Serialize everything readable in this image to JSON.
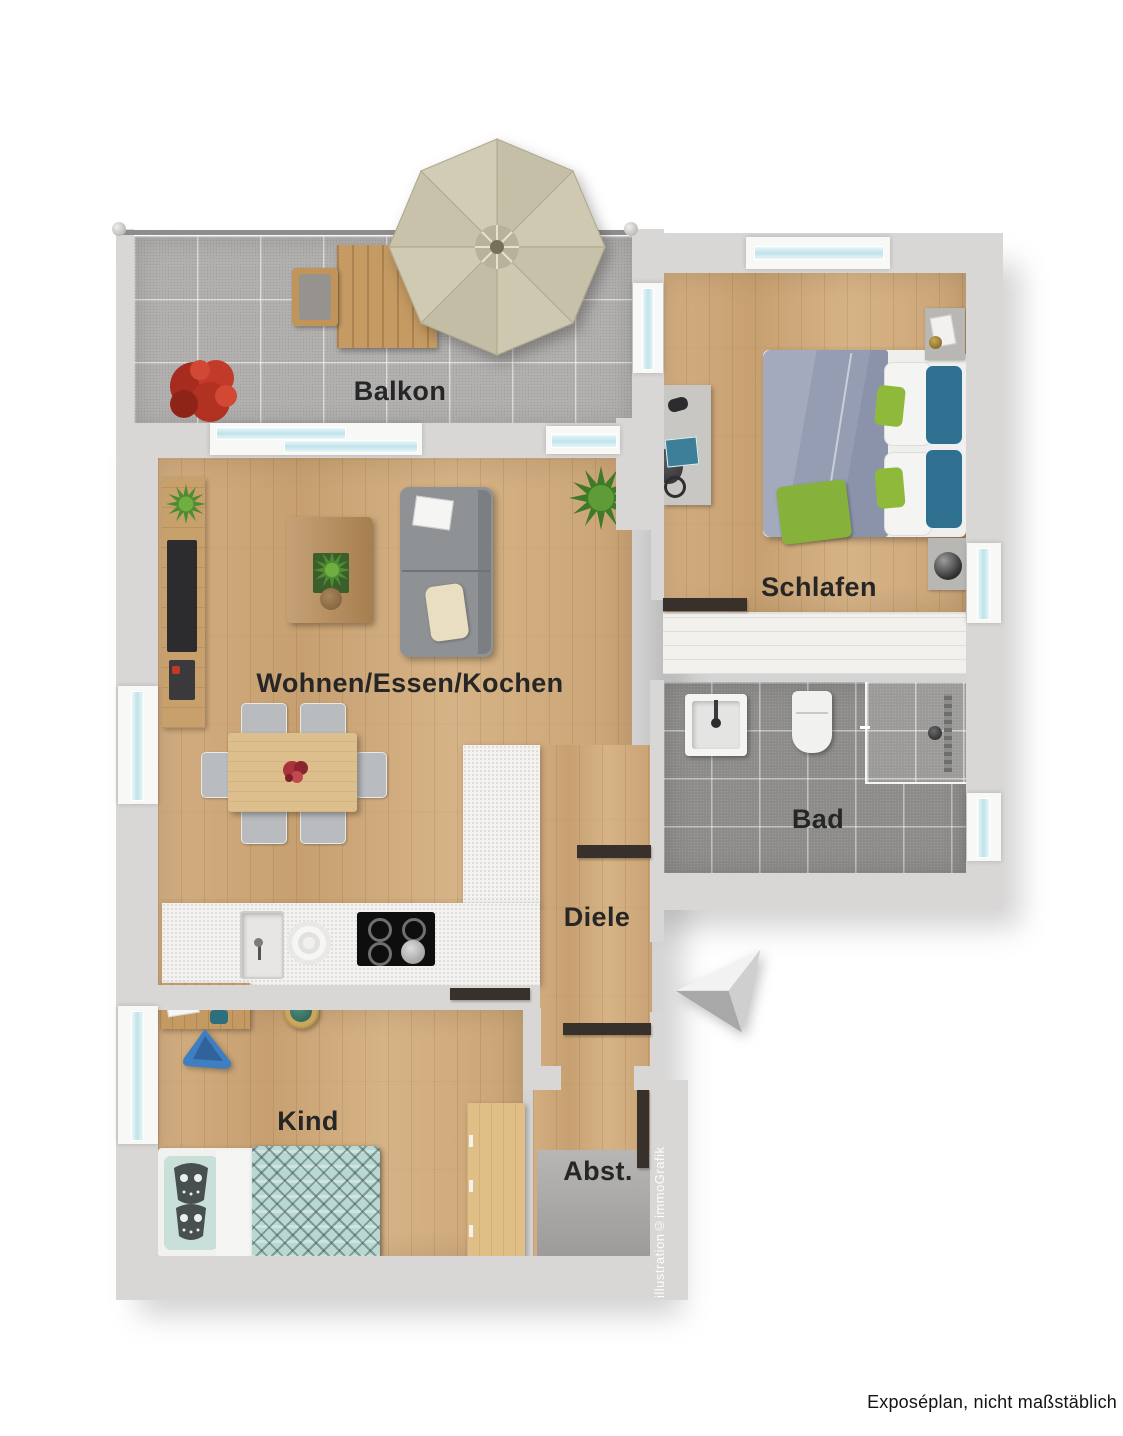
{
  "floorplan": {
    "rooms": {
      "balkon": "Balkon",
      "wohnen": "Wohnen/Essen/Kochen",
      "schlafen": "Schlafen",
      "bad": "Bad",
      "diele": "Diele",
      "kind": "Kind",
      "abst": "Abst."
    },
    "caption": "Exposéplan, nicht maßstäblich",
    "watermark": "illustration©immoGrafik",
    "colors": {
      "wall": "#d9d7d5",
      "wood_floor": "#cda97c",
      "balcony_tile": "#b2b0ae",
      "bath_tile": "#8d8c8a",
      "window_glass": "#bfe3ea",
      "label_text": "#262626",
      "door_marker": "#38302a",
      "sofa_gray": "#8f9295",
      "bed_duvet_blue": "#9aa2b8",
      "pillow_teal": "#2f6f90",
      "accent_green": "#8fb93b",
      "kids_bed_mint": "#b9d8d2",
      "umbrella_khaki": "#cdc7b1",
      "red_plant": "#b23222"
    }
  }
}
